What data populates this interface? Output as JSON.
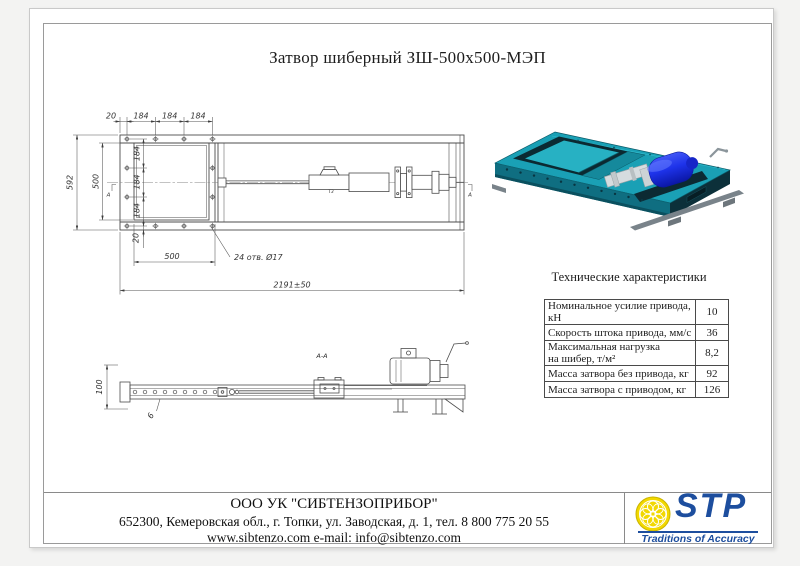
{
  "page": {
    "title": "Затвор шиберный ЗШ-500х500-МЭП"
  },
  "colors": {
    "valve_teal": "#1aa0b5",
    "motor_blue": "#1e33ea",
    "logo_blue": "#1d4e9e",
    "logo_yellow": "#f2d800"
  },
  "plan_view": {
    "top_dims": [
      "20",
      "184",
      "184",
      "184"
    ],
    "height_total": "592",
    "opening_height": "500",
    "side_dims": [
      "184",
      "184",
      "184"
    ],
    "flange_offset": "20",
    "opening_width": "500",
    "holes_note": "24 отв. Ø17",
    "total_length": "2191±50",
    "section_label_left": "А",
    "section_label_right": "А",
    "weld_label": "Т3"
  },
  "side_view": {
    "height": "100",
    "plate_thickness": "6",
    "section_title": "А-А"
  },
  "specs": {
    "title": "Технические характеристики",
    "rows": [
      {
        "label": "Номинальное усилие привода, кН",
        "value": "10"
      },
      {
        "label": "Скорость штока привода, мм/с",
        "value": "36"
      },
      {
        "label": "Максимальная нагрузка",
        "label2": "на шибер, т/м²",
        "value": "8,2"
      },
      {
        "label": "Масса затвора без привода, кг",
        "value": "92"
      },
      {
        "label": "Масса затвора с приводом, кг",
        "value": "126"
      }
    ]
  },
  "footer": {
    "company": "ООО УК \"СИБТЕНЗОПРИБОР\"",
    "address": "652300, Кемеровская обл., г. Топки, ул. Заводская, д. 1, тел. 8 800 775 20 55",
    "contacts": "www.sibtenzo.com e-mail: info@sibtenzo.com",
    "logo_text": "STP",
    "logo_tagline": "Traditions of Accuracy"
  }
}
